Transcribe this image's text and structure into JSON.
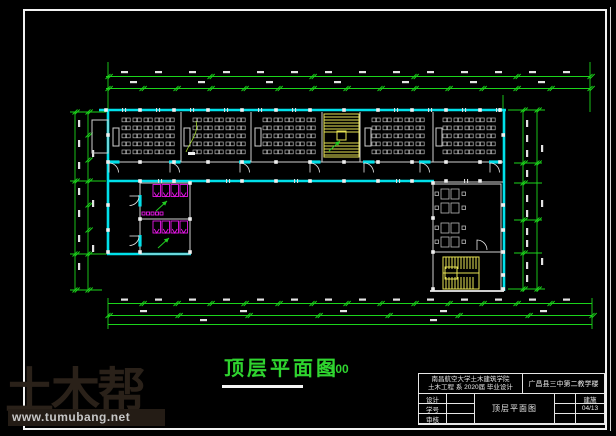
{
  "drawing": {
    "plan_title": "顶层平面图",
    "plan_scale": "1:100"
  },
  "title_block": {
    "institution_line1": "南昌航空大学土木建筑学院",
    "institution_line2": "土木工程 系 2020届 毕业设计",
    "project_name": "广昌县三中第二教学楼",
    "rows": [
      {
        "label": "设计"
      },
      {
        "label": "学号"
      },
      {
        "label": "审核"
      }
    ],
    "drawing_name": "顶层平面图",
    "category": "建施",
    "sheet_no": "04/13"
  },
  "watermark": {
    "logo": "土木帮",
    "url": "www.tumubang.net"
  },
  "colors": {
    "wall": "#00e0ea",
    "dimension_green": "#1bd41b",
    "furniture_gray": "#b8b8b8",
    "stair_yellow": "#e8e455",
    "sanitary_magenta": "#e816e8",
    "title_green": "#2fd42f",
    "watermark_brown": "#2a2119"
  }
}
